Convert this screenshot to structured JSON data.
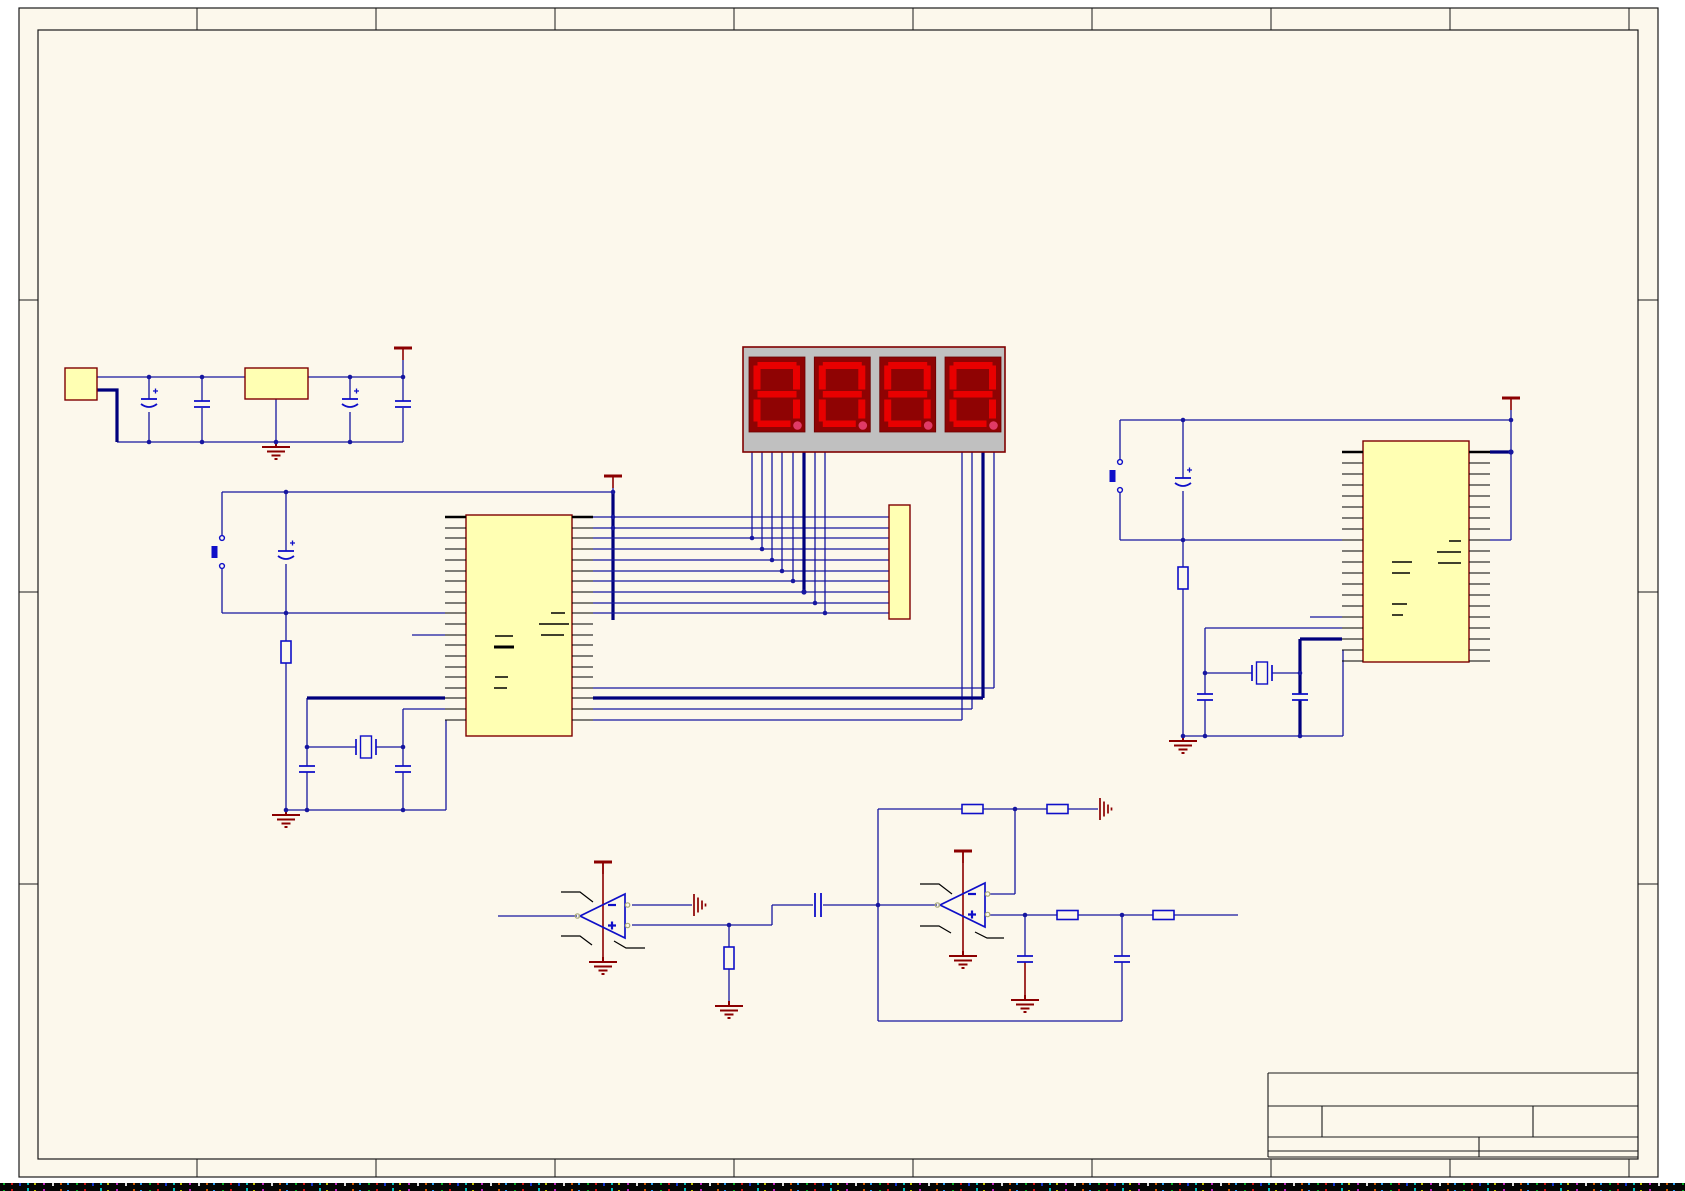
{
  "document": {
    "kind": "eda-schematic-sheet",
    "visible_text": "none"
  },
  "colors": {
    "page_margin": "#FFFFFF",
    "sheet_background": "#FCF8EC",
    "frame_line": "#1A1A1A",
    "wire": "#1717A0",
    "bus_thick_wire": "#00007D",
    "component_outline": "#0F0FC8",
    "power_symbol": "#8B0000",
    "component_fill": "#FFFFB3",
    "component_border": "#7F0000",
    "pin": "#000000",
    "display_body": "#C0C0C0",
    "display_panel": "#8F0303",
    "display_segment": "#E80000",
    "display_decimal_point": "#E03A66"
  },
  "sheet": {
    "border_zones": {
      "columns": 9,
      "rows": 4
    }
  },
  "display": {
    "digits": 4,
    "value_shown": "8.8.8.8."
  },
  "components": {
    "power_input": {
      "label": "2-pin power connector"
    },
    "regulator": {
      "label": "voltage regulator"
    },
    "mcu_left": {
      "label": "40-pin microcontroller",
      "pins_per_side": 20
    },
    "mcu_right": {
      "label": "40-pin microcontroller",
      "pins_per_side": 20
    },
    "display_module": {
      "label": "4-digit seven-segment display"
    },
    "header": {
      "label": "10-pin header"
    },
    "opamp1": {
      "label": "op-amp stage 1"
    },
    "opamp2": {
      "label": "op-amp stage 2"
    },
    "push_buttons": 2,
    "crystals": 2,
    "capacitors": 13,
    "resistors": 7,
    "ground_symbols": 8,
    "vcc_symbols": 5
  },
  "title_block": {
    "rows": 4,
    "fields_text": ""
  }
}
